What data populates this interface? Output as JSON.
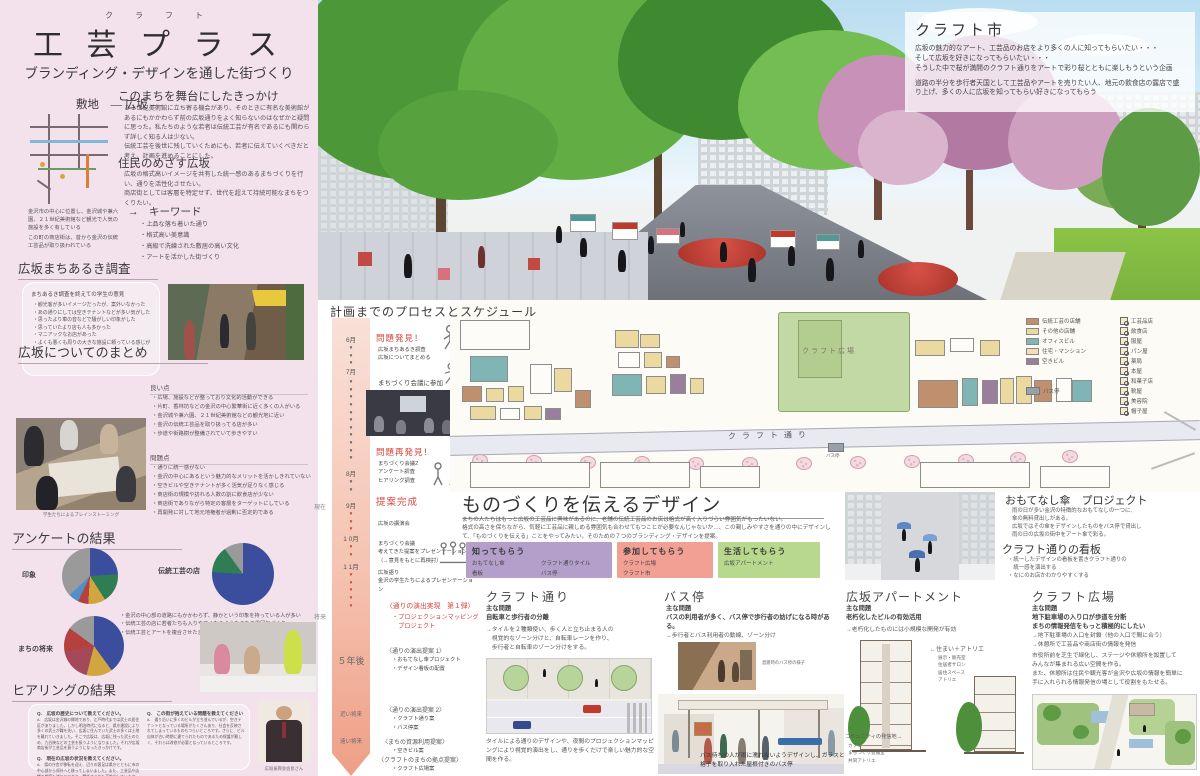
{
  "page": {
    "sidebar_bg": "#f3e1eb",
    "accent_red": "#d6463c"
  },
  "sidebar": {
    "title_furigana": "ク ラ フ ト",
    "title": "工 芸 プ ラ ス",
    "subtitle": "ブランディング・デザインを通した街づくり",
    "site": {
      "heading": "敷地　― 広坂 ―",
      "caption1": "金沢市の中心に位置し、金沢城や兼六園、２１世紀美術館など観光で人気の施設を多く有している",
      "caption2": "この町の商店街は、昔から金沢の伝統工芸品が取り扱われている"
    },
    "trigger": {
      "heading": "このまちを舞台にしたきっかけ",
      "body": "２１世紀美術館に立ち寄る機会があり、そのときに有名な美術館があるにもかかわらず前の広坂通りをよく知らないのはなぜかと疑問に思った。私たちのような若者は伝統工芸が有名であるにも関わらず詳しく知る人は少ない。\n伝統工芸を後世に残していくためにも、若者に伝えていくべきだと考え、計画を進めることにした。"
    },
    "residents": {
      "heading": "住民のめざす広坂",
      "body": "広坂の格式高いイメージを共有した統一感のあるまちづくりを行い、通りを活性化させたい。\n商店街としては客層を特定せず、世代を超えて持続可能なまちをつくりたい。"
    },
    "keywords": {
      "heading": "→　キーワード",
      "items": [
        "上品な落ち着いた通り",
        "格式高い美意識",
        "高級で洗練された敷居の高い文化",
        "アートを活かした街づくり"
      ]
    },
    "machiaruki": {
      "heading": "広坂まちあるき調査",
      "bubble_title": "まちあるき調査を終えての学生の意見",
      "items": [
        "観光客が多いイメージだったが、案外いなかった",
        "あの通りにしては空きテナントなどが多い気がした",
        "思ったより車の音などで騒がしい印象がした",
        "思っていたより店も人も多かった",
        "マニアックなお店があった",
        "よくも悪くも周りの大きな施設に頼っている感じがした"
      ]
    },
    "summary": {
      "heading": "広坂についてのまとめ",
      "good_heading": "良い点",
      "good_items": [
        "広場、施設などが整っており文化的活動ができる",
        "片町、香林坊などの金沢の中心繁華街に近く多くの人がいる",
        "金沢城や兼六園、２１世紀美術館などの観光地に近い",
        "金沢の伝統工芸品を取り扱ってる店が多い",
        "歩道や街路樹が整備されていて歩きやすい"
      ],
      "photo_caption": "学生たちによるブレインストーミング",
      "problem_heading": "問題点",
      "problem_items": [
        "通りに統一感がない",
        "金沢の中心にあるという魅力的なメリットを活かしきれていない",
        "空きビルや空きテナントが多く活気が足りなく感じる",
        "商店街の規模や訪れる人数の割に飲食店が少ない",
        "商店街でありながら特定の客層をターゲットにしている",
        "再開発に対して地元地権者が過剰に否定的である"
      ]
    },
    "survey": {
      "heading": "アンケートの結果",
      "pie1_label": "印象",
      "pie2_label": "伝統工芸の店",
      "pie3_label": "まちの将来",
      "notes": [
        "金沢の中心部の道路にもかかわらず、静かという印象を持っている人が多い",
        "伝統工芸の店に若者たちも入りやすくなるようなまちの雰囲気づくり",
        "伝統工芸とアートを複合させたまちを目指す"
      ]
    },
    "hearing": {
      "heading": "ヒアリングの結果",
      "q1": "Q.　広坂の歴史について教えてください。",
      "a1": "A.　広坂は金沢城の縁地であり、江戸時代までは武士の居住区がありました。しかし明治時代になると、県庁建設により多くの武士が職を失い、広坂に住んでいた武士の多くは土地を離れていきました。そこで広坂は、広坂に残った武士のため、九谷焼などの工芸を扱うようになりました。それが広坂商店街が工芸品を扱うようになったきっかけです。",
      "q2": "Q.　現在の広坂の状況を教えてください。",
      "a2": "A.　県の庁舎が移転を迎え、辺りの客足は県庁とともに市の中心部から郊外へと移ってしまいました。また、工芸品や店舗の顧客も減りつつあり、関係する店も高齢化しています。その間に周辺の商業施設やショッピングモールなどが増え、金沢の中心部に人が集まらなくなり、通りの賑わいが減少しています。客や観光客が少なくなったため、通りの飲食店も経営が厳しくなり、減ってしまいました。",
      "q3": "Q.　この街が抱えている問題を教えてください",
      "a3": "A.　通り沿いに多くのビルが立ち並んでいるが、空きテナントとなっている場所がたくさんあり、社会を反映されてしまっているものもつらいところです。さらに、ビル自体が古い時期に建てられたものであるため保護が難しく、それらは改修が必要となっているところです。",
      "photo_caption": "広坂振興会会長さん"
    }
  },
  "chart_data": [
    {
      "type": "pie",
      "title": "印象",
      "legend_position": "inside",
      "segments": [
        {
          "label": "静か",
          "value": 24,
          "color": "#3b4e9e"
        },
        {
          "label": "賑わい",
          "value": 17,
          "color": "#2f7d52"
        },
        {
          "label": "広い",
          "value": 10,
          "color": "#d1a53f"
        },
        {
          "label": "汚い",
          "value": 6,
          "color": "#b5413f"
        },
        {
          "label": "伝統",
          "value": 6,
          "color": "#4f90c9"
        },
        {
          "label": "その他",
          "value": 37,
          "color": "#9a9a9a"
        }
      ]
    },
    {
      "type": "pie",
      "title": "伝統工芸の店",
      "legend_position": "inside",
      "segments": [
        {
          "label": "入りたい",
          "value": 76,
          "color": "#3b4e9e"
        },
        {
          "label": "入りたくない",
          "value": 14,
          "color": "#2f7d52"
        },
        {
          "label": "その他",
          "value": 10,
          "color": "#9a9a9a"
        }
      ]
    },
    {
      "type": "pie",
      "title": "まちの将来",
      "legend_position": "inside",
      "segments": [
        {
          "label": "アート広場",
          "value": 40,
          "color": "#3b4e9e"
        },
        {
          "label": "伝統の店",
          "value": 14,
          "color": "#d1a53f"
        },
        {
          "label": "若者向け",
          "value": 18,
          "color": "#a5485a"
        },
        {
          "label": "緑を増やす",
          "value": 13,
          "color": "#b5413f"
        },
        {
          "label": "その他",
          "value": 15,
          "color": "#9a9a9a"
        }
      ]
    }
  ],
  "hero": {
    "craft_market": {
      "title": "クラフト市",
      "para1": "広坂の魅力的なアート、工芸品のお店をより多くの人に知ってもらいたい・・・\nそして広坂を好きになってもらいたい・・・\nそうした中で桜が満開のクラフト通りをアートで彩り桜とともに楽しもうという企画",
      "para2": "道路の半分を歩行者天国として工芸品やアートを売りたい人、地元の飲食店の露店で盛り上げ、多くの人に広坂を知ってもらい好きになってもらう"
    }
  },
  "process": {
    "heading": "計画までのプロセスとスケジュール",
    "now_label": "現在",
    "future_label": "将来",
    "months": [
      "6月",
      "7月",
      "8月",
      "9月",
      "1 0月",
      "1 1月"
    ],
    "arrow_runs": [
      "▼\n▼\n▼",
      "▼\n▼\n▼\n▼\n▼\n▼\n▼\n▼\n▼\n▼\n▼",
      "▼\n▼",
      "▼\n▼\n▼",
      "▼\n▼",
      "▼\n▼\n▼\n▼\n▼"
    ],
    "m1_title": "問題発見！",
    "m1_items": [
      "広坂まちあるき調査",
      "広坂についてまとめる"
    ],
    "m2": "まちづくり会議に参加",
    "m3_title": "問題再発見！",
    "m3_items": [
      "まちづくり会議2",
      "アンケート調査",
      "ヒアリング調査"
    ],
    "m4_title": "提案完成",
    "m4_item": "広坂の講演会",
    "m5_items": [
      "まちづくり会議",
      "考えてきた提案をプレゼンテーション",
      "（→意見をもとに再検討）"
    ],
    "m6_items": [
      "広坂語り",
      "金沢の学生たちによるプレゼンテーション"
    ],
    "r1_title": "〈通りの演出実現　第１弾〉",
    "r1_items": [
      "・プロジェクションマッピング",
      "　プロジェクト"
    ],
    "p1_title": "〈通りの演出提案 1〉",
    "p1_items": [
      "・おもてなし傘プロジェクト",
      "・デザイン看板の配置"
    ],
    "y5": "５年後",
    "p2_title": "〈通りの演出提案 2〉",
    "p2_items": [
      "・クラフト通り案",
      "・バス停案"
    ],
    "near_label": "近い将来",
    "p3_title": "〈まちの資源利用提案〉",
    "p3_items": [
      "・空きビル案"
    ],
    "far_label": "遠い将来",
    "p4_title": "〈クラフトのまちの拠点提案〉",
    "p4_items": [
      "・クラフト広場案"
    ]
  },
  "siteplan": {
    "plaza_label": "クラフト広場",
    "street_label": "クラフト通り",
    "busstop_label": "バス停",
    "legend": [
      {
        "label": "伝統工芸の店舗",
        "color": "#c08f6e"
      },
      {
        "label": "その他の店舗",
        "color": "#ecd9a0"
      },
      {
        "label": "オフィスビル",
        "color": "#7fb5b5"
      },
      {
        "label": "住宅・マンション",
        "color": "#f5ddb5"
      },
      {
        "label": "空きビル",
        "color": "#9a7f9d"
      }
    ],
    "icon_legend": [
      "工芸品店",
      "飲食店",
      "服屋",
      "パン屋",
      "薬局",
      "本屋",
      "和菓子店",
      "靴屋",
      "美容院",
      "帽子屋"
    ]
  },
  "design": {
    "heading": "ものづくりを伝えるデザイン",
    "body": "まちの人たちはもっと広坂の工芸品に興味があるのに、老舗の伝統工芸品のお店は格式が高く入りづらい雰囲気がもったいない。\n格式の高さを保ちながら、気軽に工芸品に親しめる雰囲気も合わせてもつことが必要なんじゃないか…、この親しみやすさを通りの中にデザインして、「ものづくりを伝える」ことをやってみたい。そのための７つのブランディング・デザインを提案。",
    "boxes": [
      {
        "title": "知ってもらう",
        "color": "#b49fca",
        "items": [
          "おもてなし傘",
          "クラフト通りタイル",
          "看板",
          "バス停"
        ]
      },
      {
        "title": "参加してもらう",
        "color": "#f2a094",
        "items": [
          "クラフト広場",
          "クラフト市"
        ]
      },
      {
        "title": "生活してもらう",
        "color": "#b8d98d",
        "items": [
          "広坂アパートメント"
        ]
      }
    ]
  },
  "sections": {
    "craft_street": {
      "title": "クラフト通り",
      "problem_label": "主な問題",
      "problem": "自転車と歩行者の分離",
      "solution": "→タイルを２種類使い、歩く人と立ち止まる人の\n　視覚的なゾーン分けと、自転車レーンを作り、\n　歩行者と自転車のゾーン分けをする。",
      "caption": "タイルによる通りのデザインや、夜間のプロジェクションマッピングにより視覚的演出をし、通りを歩くだけで楽しい魅力的な空間を作る。"
    },
    "bus_stop": {
      "title": "バス停",
      "problem_label": "主な問題",
      "problem": "バスの利用者が多く、バス停で歩行者の妨げになる時がある。",
      "solution": "→歩行者とバス利用者の動線、ゾーン分け",
      "photo_caption": "混雑時のバス停の様子",
      "caption": "バス待ちの人が雨に濡れないようデザインし、ガラスと格子を取り入れた屋根付きのバス停"
    },
    "apartment": {
      "title": "広坂アパートメント",
      "problem_label": "主な問題",
      "problem": "老朽化したビルの有効活用",
      "solution": "→老朽化したものには小規模な開発が有効",
      "annotation": "←住まい＋アトリエ",
      "annotation_items": [
        "展示・販売室",
        "住居者サロン",
        "居住スペース",
        "アトリエ"
      ],
      "community": "コミュニティの発信地→",
      "community_items": [
        "カフェ",
        "まちづくり会議室",
        "共同アトリエ"
      ]
    },
    "omotenashi": {
      "title": "おもてなし傘　プロジェクト",
      "body": "雨の日が多い金沢の特徴的なおもてなしの一つに、\n傘の無料貸出しがある。\n広坂ではその傘をデザインしたものをバス停で貸出し\n雨の日の広坂の街中をアート傘で彩る。"
    },
    "signboard": {
      "title": "クラフト通りの看板",
      "items": [
        "統一したデザインの看板を置きクラフト通りの\n　統一感を演出する",
        "なにのお店かわかりやすくする"
      ]
    },
    "craft_plaza": {
      "title": "クラフト広場",
      "problem_label": "主な問題",
      "problems": "地下駐車場の入り口が歩道を分断\nまちの情報発信をもっと積極的にしたい",
      "solutions": "→地下駐車場の入口を封鎖（他の入口で間に合う）\n→休憩所で工芸品や商店街の情報を発信",
      "body": "市役所前を芝生で緑化し、ステージや休憩所を設置して\nみんなが集まれる広い空間を作る。\nまた、休憩所は住民や観光客が金沢や広坂の情報を簡単に\n手に入れられる情報発信の場として役割をもたせる。"
    }
  }
}
